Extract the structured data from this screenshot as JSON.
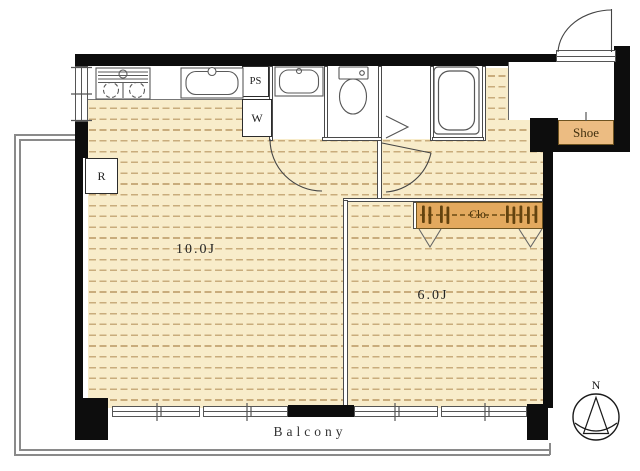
{
  "plan": {
    "rooms": [
      {
        "name": "living-room",
        "label": "10.0J"
      },
      {
        "name": "bedroom",
        "label": "6.0J"
      }
    ],
    "labels": {
      "balcony": "Balcony",
      "shoe_cabinet": "Shoe",
      "closet": "Clo.",
      "pipe_space": "PS",
      "washing_machine": "W",
      "refrigerator": "R"
    },
    "compass": {
      "north_label": "N"
    },
    "colors": {
      "floor": "#f8ecca",
      "floor_dash": "#c9ac7c",
      "closet_fill": "#e3a95e",
      "shoe_fill": "#ecbc82",
      "wall": "#0d0d0d"
    }
  }
}
